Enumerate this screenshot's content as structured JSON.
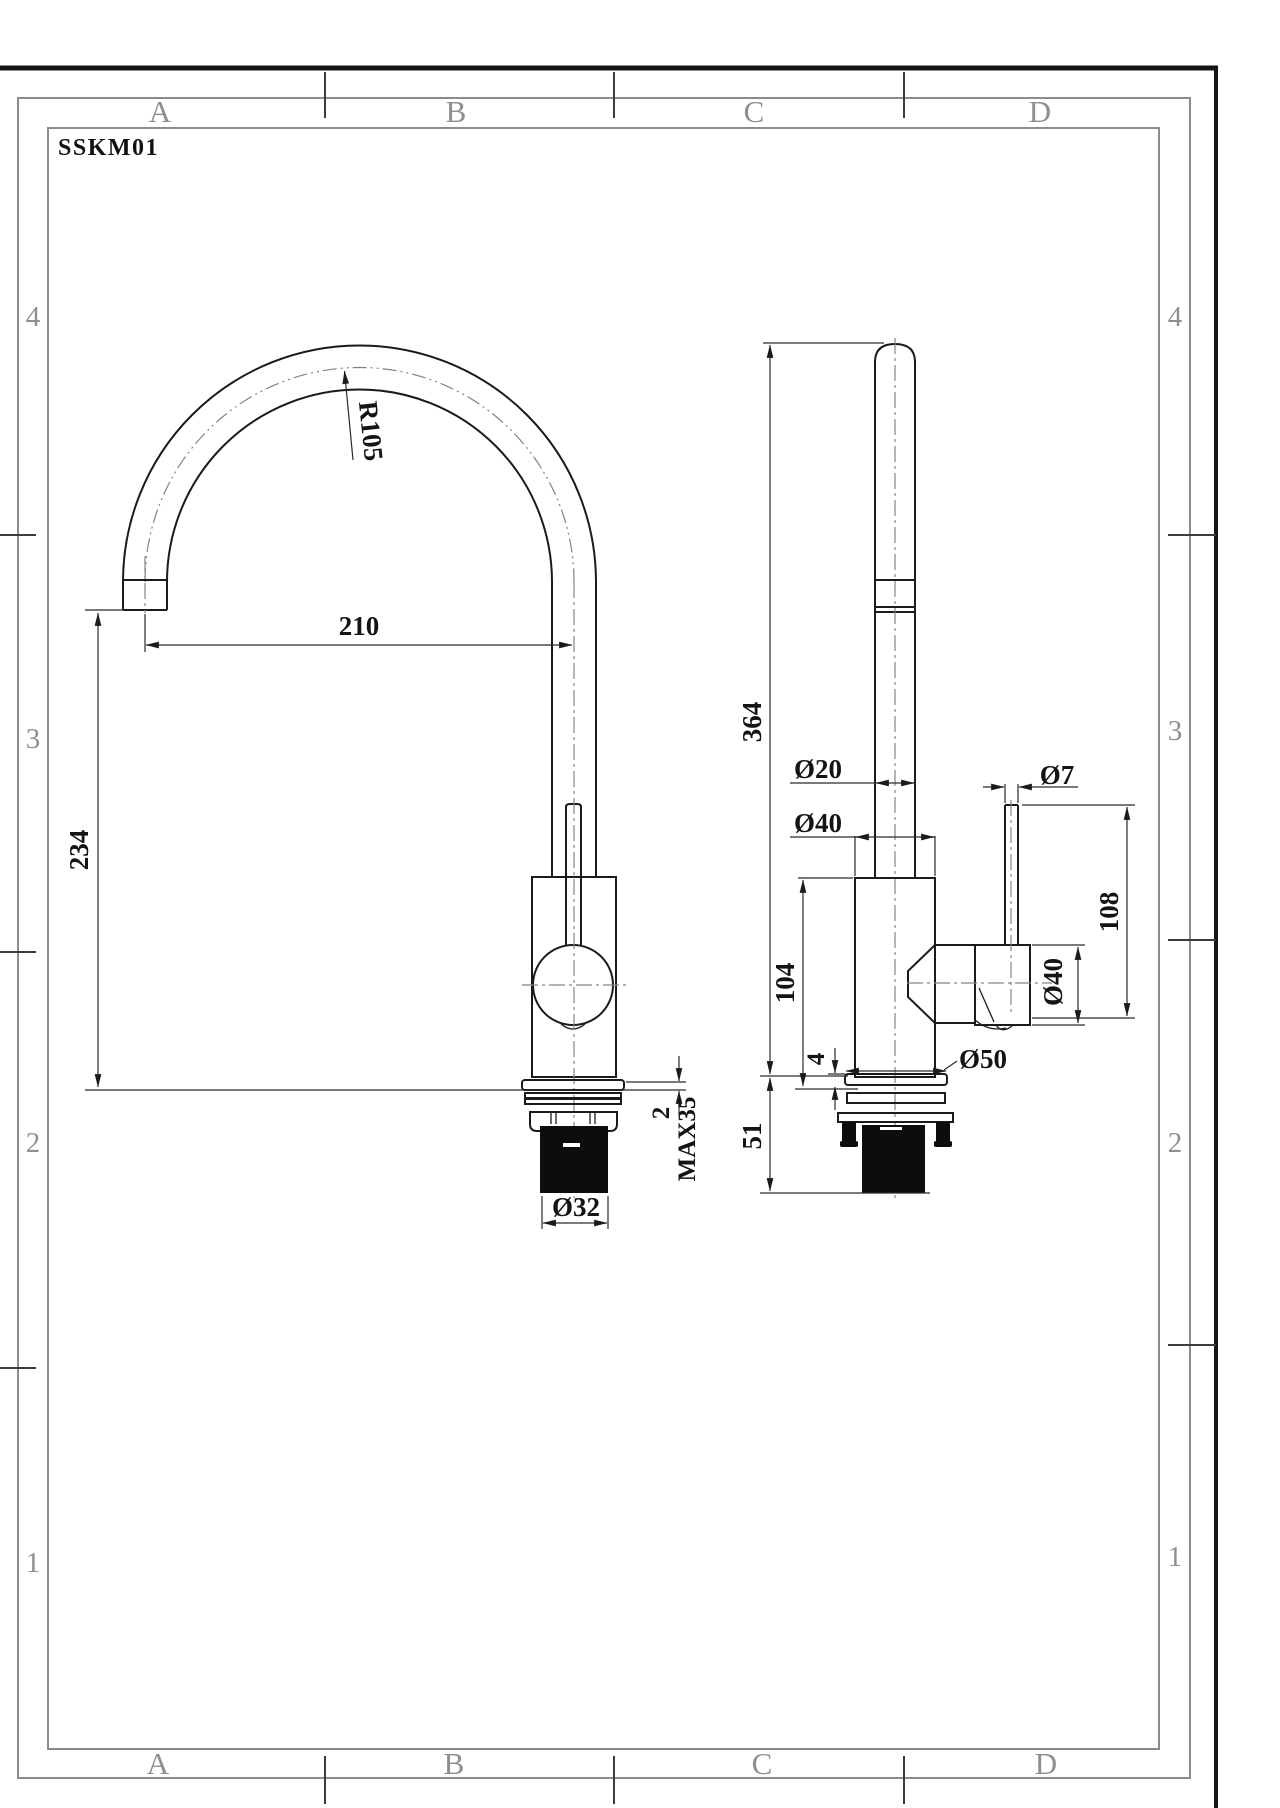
{
  "drawing": {
    "code": "SSKM01",
    "grid": {
      "cols": [
        "A",
        "B",
        "C",
        "D"
      ],
      "rows": [
        "4",
        "3",
        "2",
        "1"
      ]
    },
    "front_view": {
      "spout_radius": "R105",
      "spout_reach": "210",
      "spout_height": "234",
      "deck_plate_thickness": "2",
      "max_mount_thickness": "MAX35",
      "shank_diameter": "Ø32"
    },
    "side_view": {
      "overall_height": "364",
      "spout_tube_diameter": "Ø20",
      "body_diameter": "Ø40",
      "lever_rod_diameter": "Ø7",
      "body_height": "104",
      "lever_height": "108",
      "handle_diameter": "Ø40",
      "base_flange_diameter": "Ø50",
      "flange_thickness": "4",
      "under_deck_length": "51"
    },
    "colors": {
      "paper": "#ffffff",
      "outline": "#1b1b1b",
      "dimension": "#2a2a2a",
      "centerline": "#8c8272",
      "frame": "#8c8c8c",
      "scan_edge": "#141414"
    }
  }
}
